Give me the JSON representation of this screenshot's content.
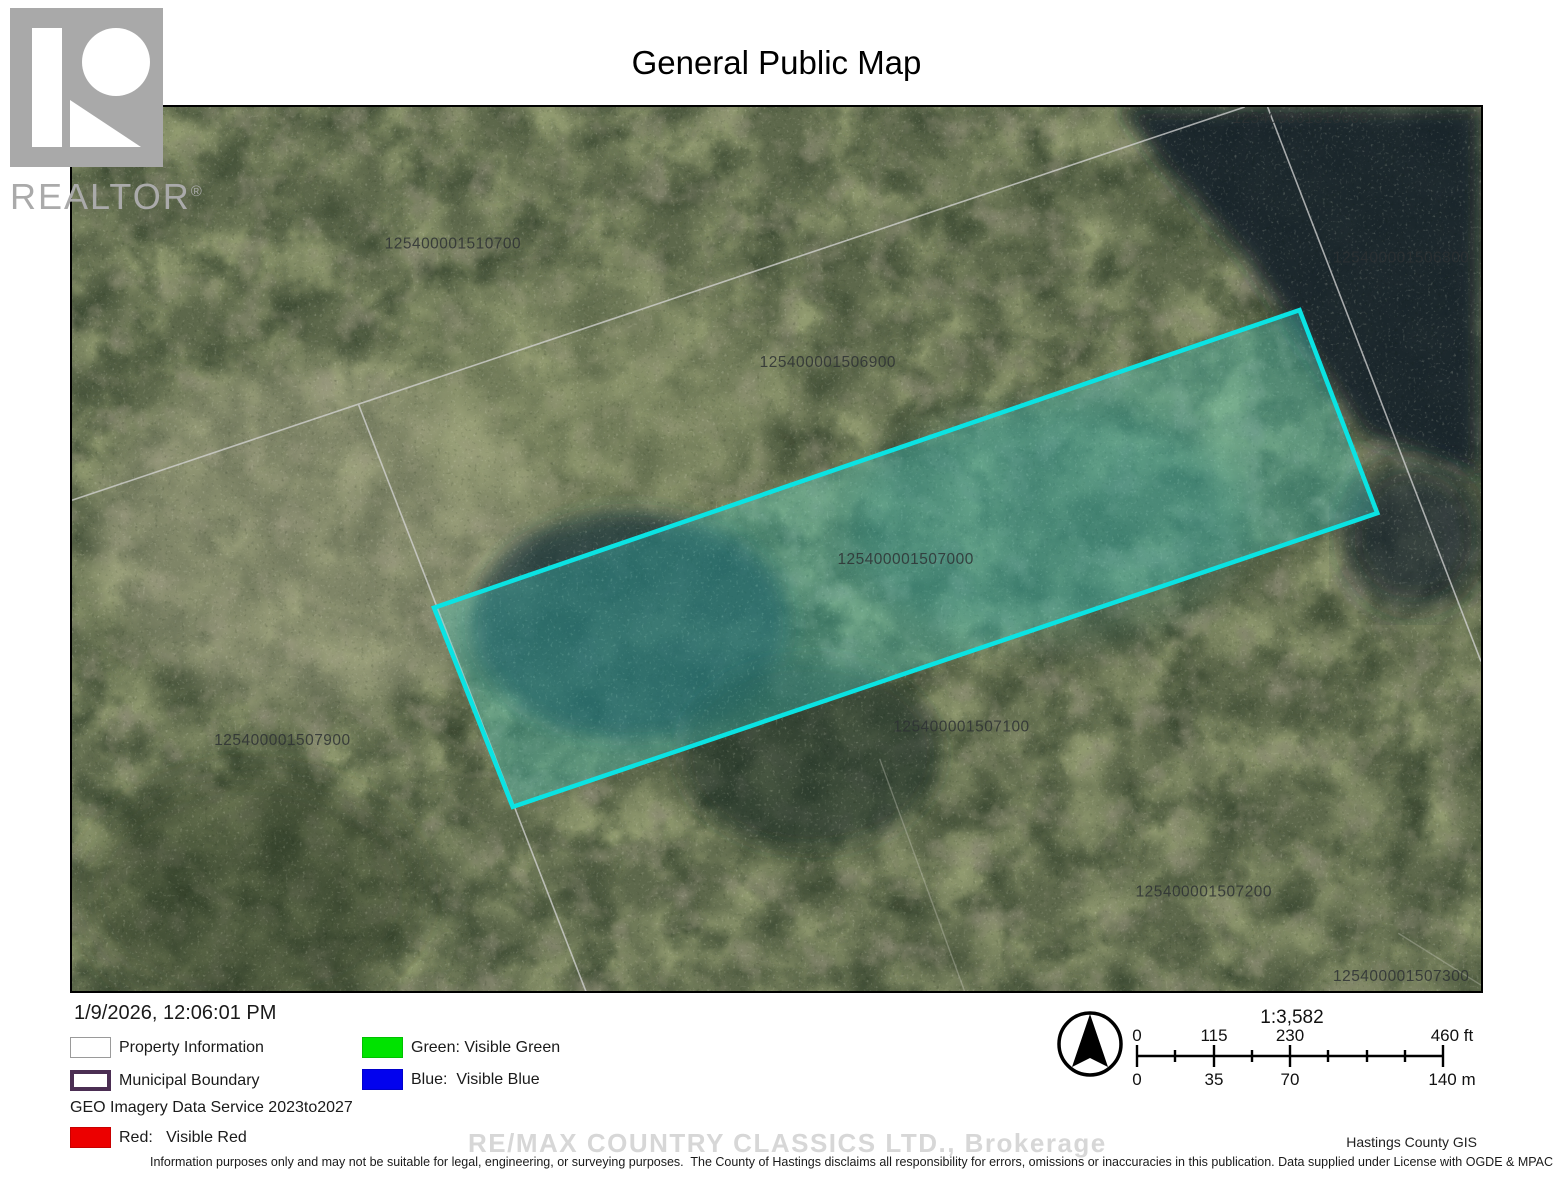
{
  "title": "General Public Map",
  "logo": {
    "label": "REALTOR",
    "registered": "®"
  },
  "map": {
    "parcels": [
      "125400001510700",
      "125400001506900",
      "125400001510600",
      "125400001506800",
      "125400001507000",
      "125400001507900",
      "125400001507100",
      "125400001507200",
      "125400001507300"
    ],
    "highlight_color": "#0be3e3"
  },
  "footer": {
    "timestamp": "1/9/2026, 12:06:01 PM",
    "geo_note": "GEO Imagery Data Service 2023to2027",
    "watermark": "RE/MAX COUNTRY CLASSICS LTD., Brokerage",
    "credit": "Hastings County GIS",
    "disclaimer": "Information purposes only and may not be suitable for legal, engineering, or surveying purposes.  The County of Hastings disclaims all responsibility for errors, omissions or inaccuracies in this publication. Data supplied under License with OGDE & MPAC."
  },
  "legend": {
    "property": "Property Information",
    "municipal": "Municipal Boundary",
    "green": "Green: Visible Green",
    "blue": "Blue:  Visible Blue",
    "red": "Red:   Visible Red"
  },
  "legend_colors": {
    "green": "#00e300",
    "blue": "#0202ee",
    "red": "#ec0000",
    "municipal_border": "#4b2e53"
  },
  "scalebar": {
    "ratio": "1:3,582",
    "ft": [
      "0",
      "115",
      "230",
      "460 ft"
    ],
    "m": [
      "0",
      "35",
      "70",
      "140 m"
    ]
  }
}
